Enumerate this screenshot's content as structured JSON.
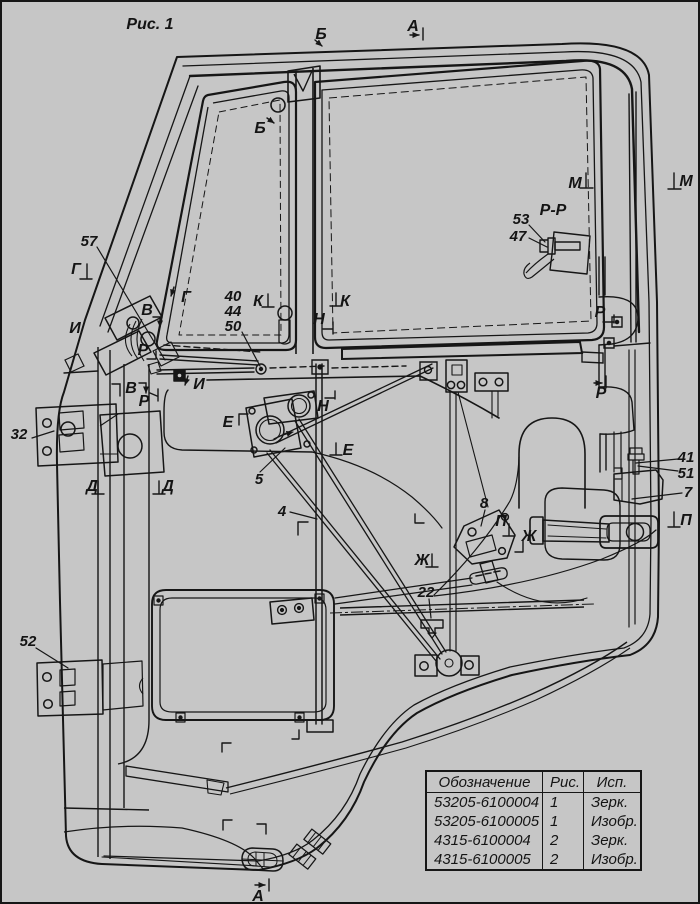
{
  "colors": {
    "background": "#c6c6c6",
    "line": "#1a1a1a"
  },
  "figure_caption": "Рис. 1",
  "view_labels": {
    "a_top": "А",
    "a_bottom": "А",
    "b_top": "Б",
    "b_vent": "Б",
    "m_left": "М",
    "m_right": "М",
    "pp": "Р-Р",
    "g_pillar": "Г",
    "g_mid": "Г",
    "v_upper": "В",
    "v_lower": "В",
    "i_upper": "И",
    "i_lower": "И",
    "r_hinge_upper": "Р",
    "r_hinge_lower": "Р",
    "r_rear_upper": "Р",
    "r_rear_lower": "Р",
    "k_left": "К",
    "k_right": "К",
    "n_upper": "Н",
    "n_lower": "Н",
    "d_left": "Д",
    "d_right": "Д",
    "e_left": "Е",
    "e_right": "Е",
    "zh_left": "Ж",
    "zh_right": "Ж",
    "p_mid": "П",
    "p_right": "П"
  },
  "part_callouts": {
    "n57": "57",
    "n40": "40",
    "n44": "44",
    "n50": "50",
    "n53": "53",
    "n47": "47",
    "n32": "32",
    "n5": "5",
    "n4": "4",
    "n8": "8",
    "n22": "22",
    "n41": "41",
    "n51": "51",
    "n7": "7",
    "n52": "52"
  },
  "table": {
    "headers": [
      "Обозначение",
      "Рис.",
      "Исп."
    ],
    "rows": [
      [
        "53205-6100004",
        "1",
        "Зерк."
      ],
      [
        "53205-6100005",
        "1",
        "Изобр."
      ],
      [
        "4315-6100004",
        "2",
        "Зерк."
      ],
      [
        "4315-6100005",
        "2",
        "Изобр."
      ]
    ]
  }
}
